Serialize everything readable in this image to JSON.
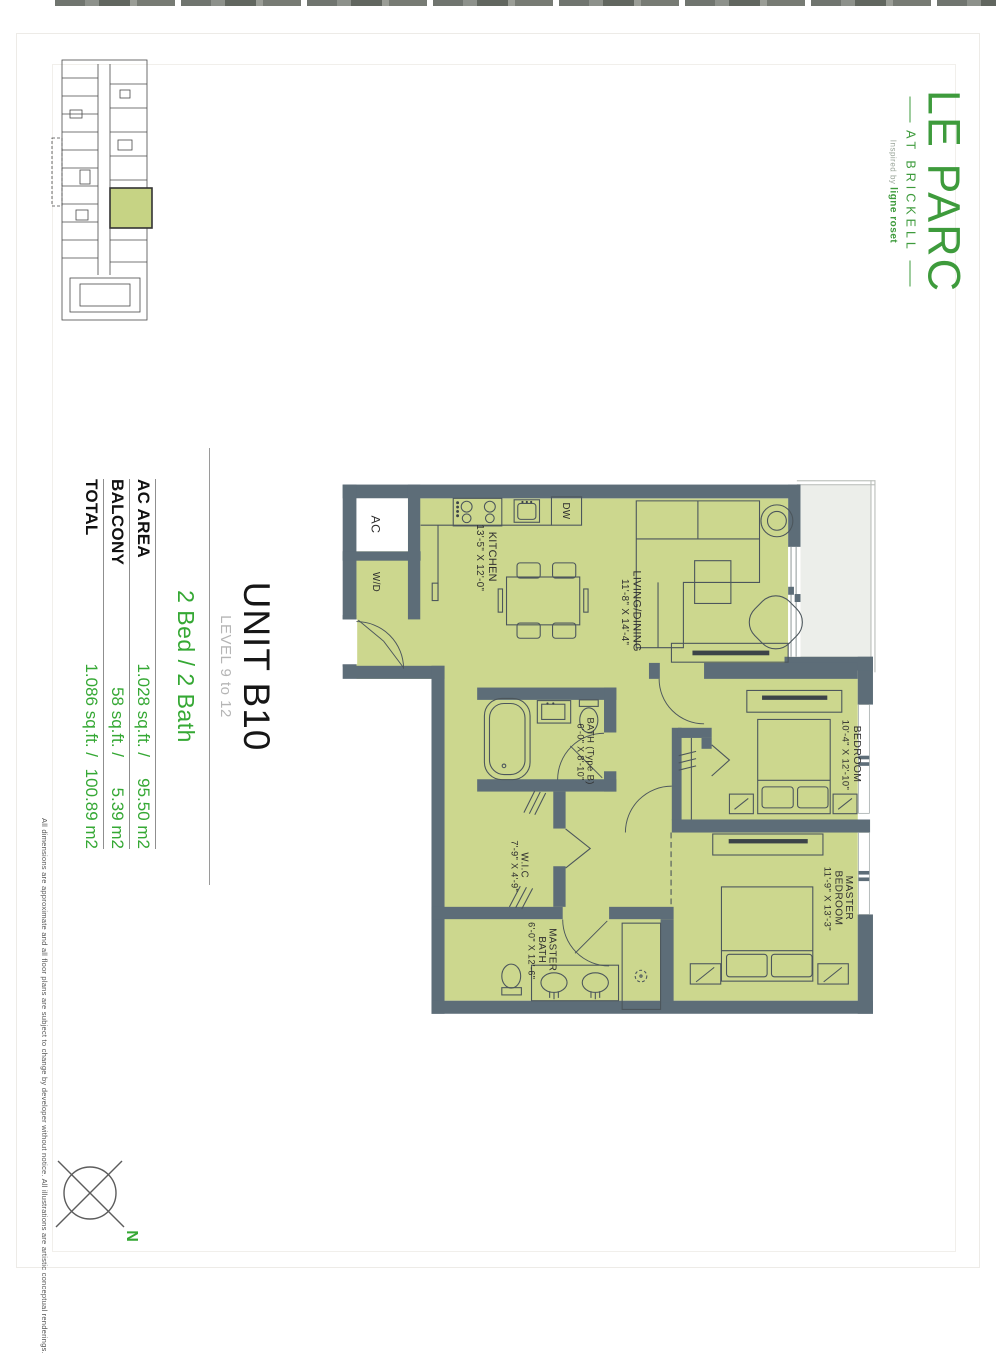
{
  "logo": {
    "name": "LE PARC",
    "subtitle": "AT BRICKELL",
    "tagline_prefix": "Inspired by",
    "tagline_brand": "ligne roset",
    "green": "#3E9B3C"
  },
  "unit": {
    "title": "UNIT B10",
    "level": "LEVEL 9 to 12",
    "config": "2 Bed / 2 Bath",
    "areas": [
      {
        "label": "AC AREA",
        "imperial": "1.028 sq.ft. /",
        "metric": "95.50 m2"
      },
      {
        "label": "BALCONY",
        "imperial": "58 sq.ft. /",
        "metric": "5.39 m2"
      },
      {
        "label": "TOTAL",
        "imperial": "1.086 sq.ft. /",
        "metric": "100.89 m2"
      }
    ]
  },
  "floorplan": {
    "rooms": {
      "kitchen": {
        "name": "KITCHEN",
        "dims": "13'-5\" X 12'-0\""
      },
      "living": {
        "name": "LIVING/DINING",
        "dims": "11'-8\" X 14'-4\""
      },
      "bath": {
        "name": "BATH (Type B)",
        "dims": "6'-0\" X 8'-10\""
      },
      "wic": {
        "name": "W.I.C",
        "dims": "7'-9\" X 4'-9\""
      },
      "bedroom": {
        "name": "BEDROOM",
        "dims": "10'-4\" X 12'-10\""
      },
      "master_bedroom": {
        "l1": "MASTER",
        "l2": "BEDROOM",
        "dims": "11'-9\" X 13'-3\""
      },
      "master_bath": {
        "l1": "MASTER",
        "l2": "BATH",
        "dims": "6'-0\" X 12'-6\""
      }
    },
    "fixtures": {
      "ac": "AC",
      "wd": "W/D",
      "dw": "DW"
    },
    "colors": {
      "room_fill": "#ccd78e",
      "wall": "#5d6d78",
      "balcony_fill": "#eceeea"
    }
  },
  "compass": {
    "north_label": "N"
  },
  "disclaimer": "All dimensions are approximate and all floor plans are subject to change by developer without notice. All illustrations are artistic conceptual renderings."
}
